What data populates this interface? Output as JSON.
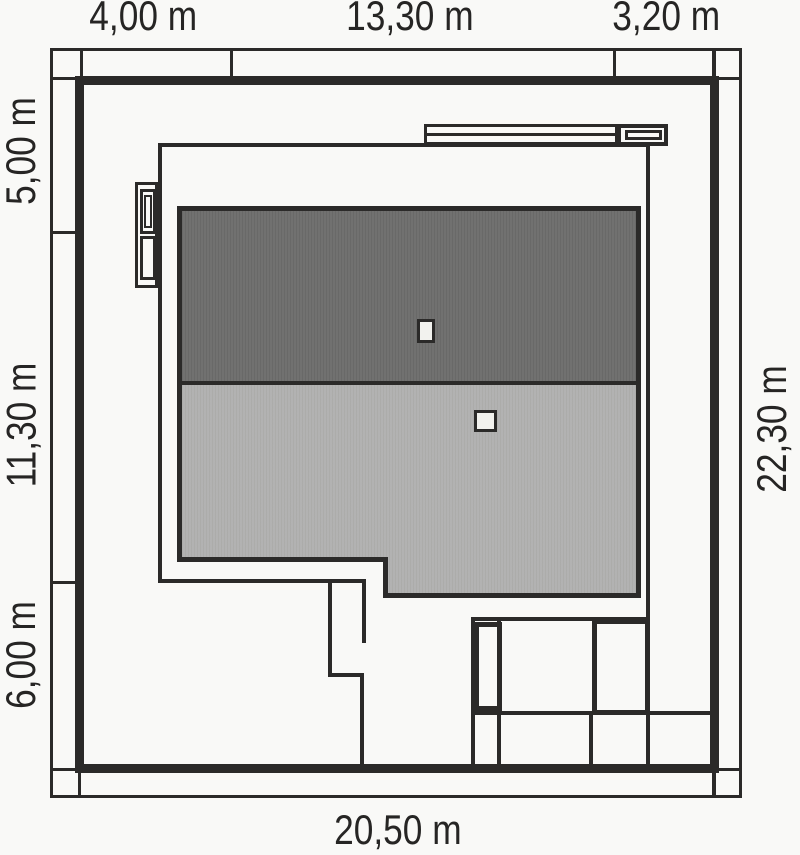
{
  "title": "House plot site plan",
  "dimensions": {
    "top": [
      "4,00 m",
      "13,30 m",
      "3,20 m"
    ],
    "left": [
      "5,00 m",
      "11,30 m",
      "6,00 m"
    ],
    "right": [
      "22,30 m"
    ],
    "bottom": [
      "20,50 m"
    ]
  },
  "colors": {
    "background": "#F9F9F7",
    "line": "#2B2A29",
    "roof_dark": "#6E6E6D",
    "roof_light": "#B1B1B0",
    "chimney_fill": "#F2F2EE",
    "text": "#262524"
  }
}
